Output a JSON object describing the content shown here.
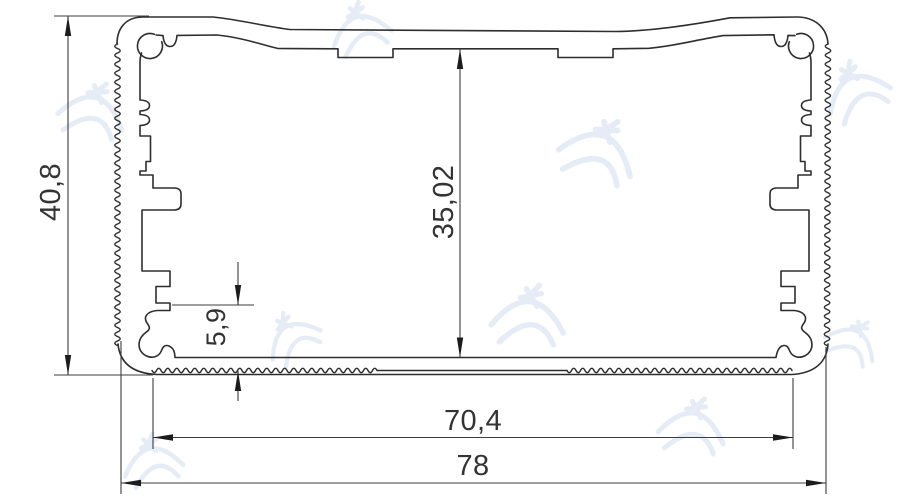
{
  "drawing": {
    "kind": "extrusion-profile-cross-section",
    "dimensions": {
      "overall_height": {
        "value": "40,8",
        "orientation": "vertical"
      },
      "inner_height": {
        "value": "35,02",
        "orientation": "vertical"
      },
      "slot_height": {
        "value": "5,9",
        "orientation": "vertical"
      },
      "inner_width": {
        "value": "70,4",
        "orientation": "horizontal"
      },
      "overall_width": {
        "value": "78",
        "orientation": "horizontal"
      }
    },
    "colors": {
      "profile_line": "#2e2e2e",
      "dimension_line": "#3c3c3c",
      "label_text": "#333333",
      "watermark": "#cfddee",
      "background": "#ffffff"
    }
  }
}
